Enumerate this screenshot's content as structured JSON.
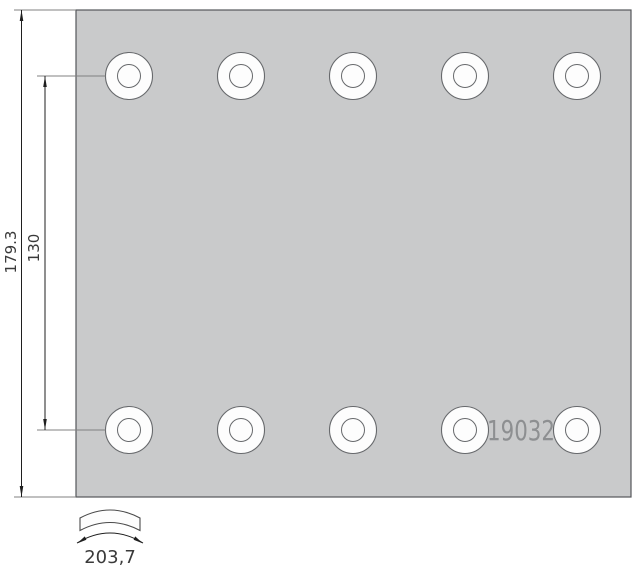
{
  "drawing": {
    "part_number": "19032",
    "dimensions": {
      "overall_height": "179.3",
      "hole_row_spacing": "130",
      "arc_length": "203,7"
    },
    "plate": {
      "hole_rows": 2,
      "hole_columns": 5,
      "hole_count": 10,
      "row_y": [
        76,
        430
      ],
      "col_x": [
        129,
        241,
        353,
        465,
        577
      ],
      "hole_outer_radius": 23.5,
      "hole_inner_radius": 11.5
    },
    "colors": {
      "background": "#ffffff",
      "plate_fill": "#c9cacb",
      "plate_stroke": "#55575a",
      "hole_fill": "#fdfdfd",
      "hole_stroke": "#67696c",
      "extension_line": "#808080",
      "dimension_line": "#1f1f1f",
      "dimension_text": "#3a3a3a",
      "part_number_text": "#8d8f91",
      "section_outline": "#4a4a4a"
    }
  }
}
